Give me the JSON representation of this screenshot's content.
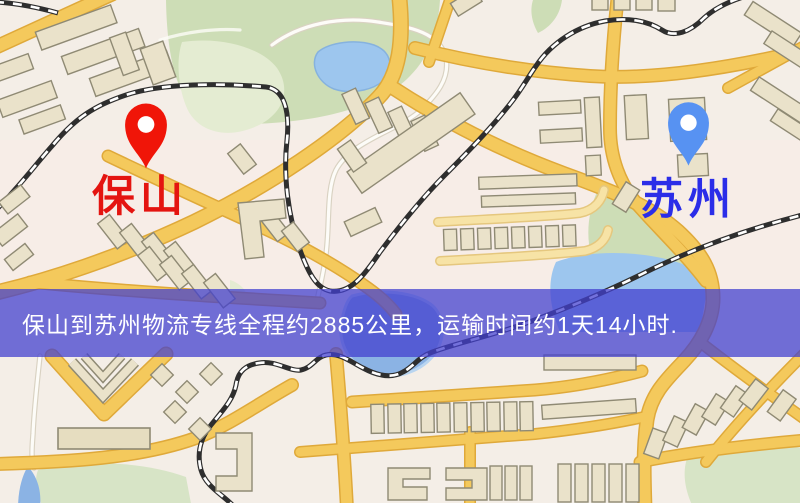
{
  "map": {
    "colors": {
      "background": "#f4eee7",
      "road": "#f4c95c",
      "park": "#cdddb6",
      "water": "#9dc6ee",
      "railway": "#2e2e2e"
    }
  },
  "markers": {
    "origin": {
      "label": "保山",
      "color": "#f01508"
    },
    "destination": {
      "label": "苏州",
      "color": "#5792f2"
    }
  },
  "banner": {
    "text": "保山到苏州物流专线全程约2885公里，运输时间约1天14小时.",
    "background_color": "#4240ce",
    "text_color": "#ffffff"
  }
}
